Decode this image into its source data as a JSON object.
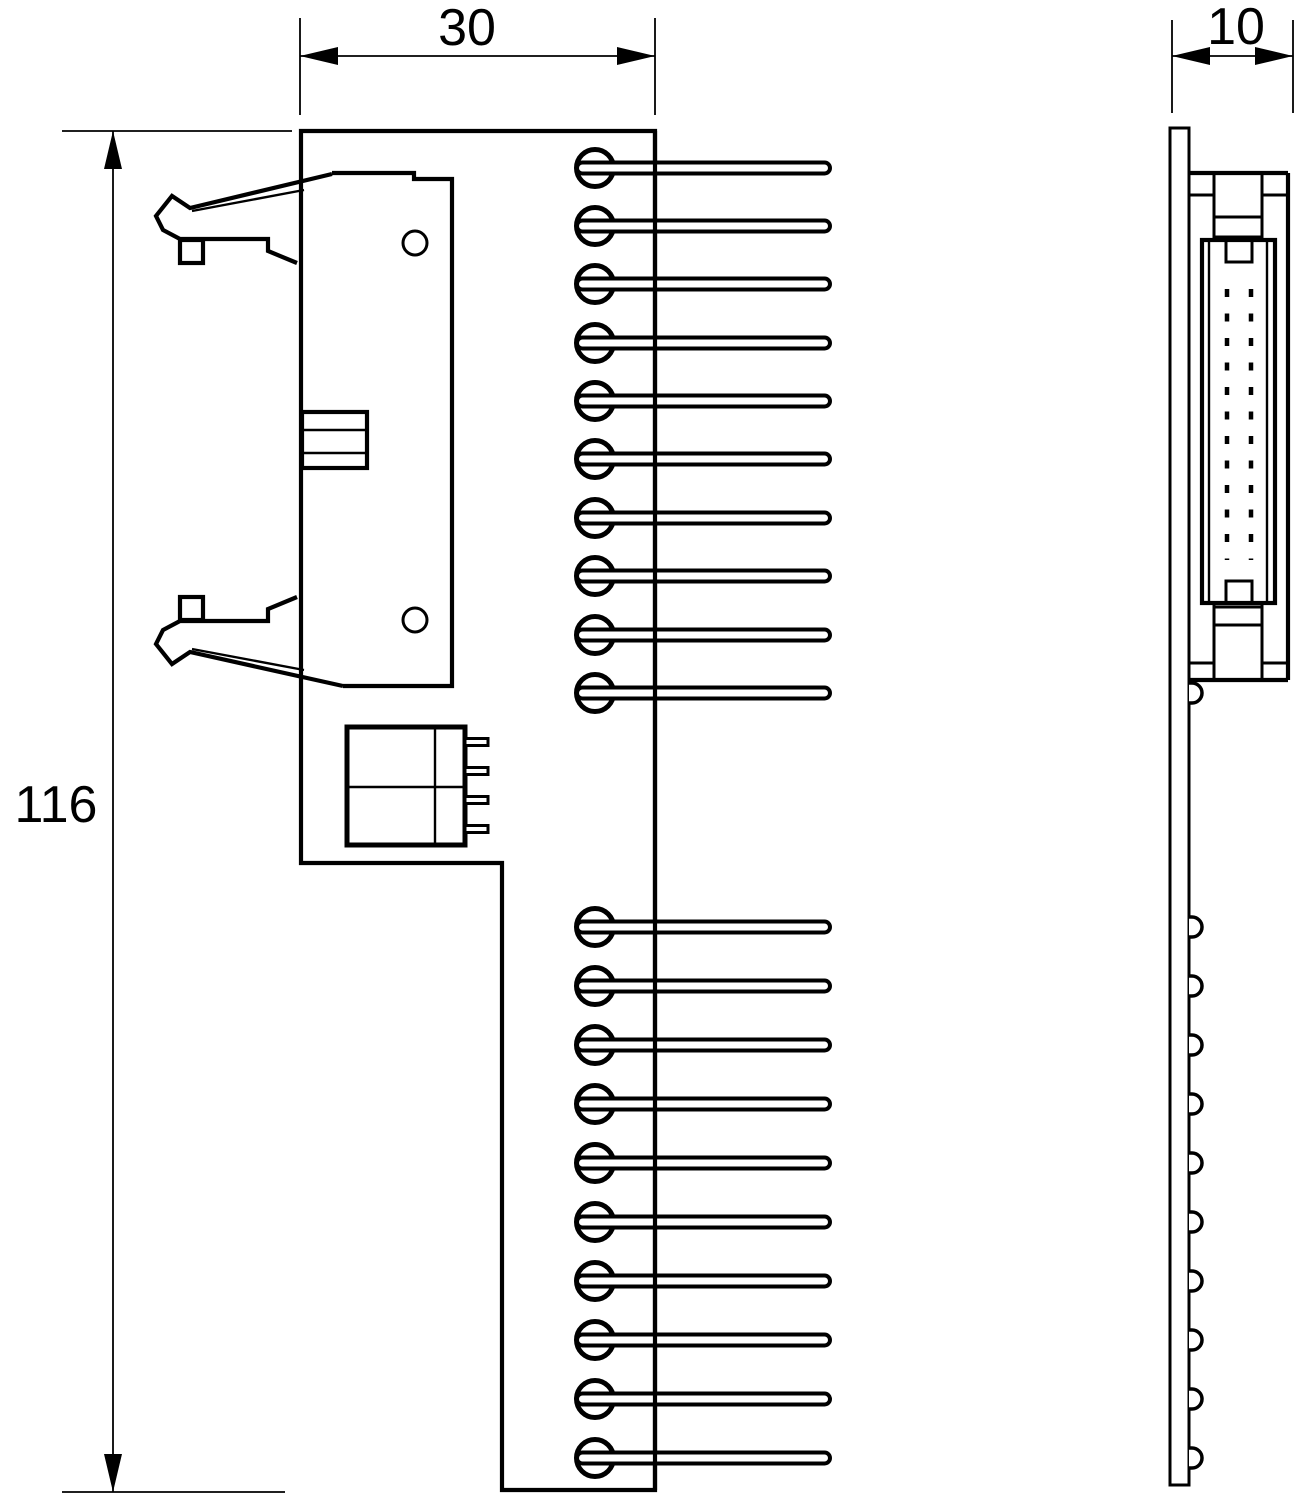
{
  "drawing": {
    "colors": {
      "background": "#ffffff",
      "line": "#000000"
    },
    "dimensions": {
      "front_width": "30",
      "front_height": "116",
      "side_depth": "10"
    },
    "front_view": {
      "upper_pin_ys": [
        168,
        226,
        284,
        343,
        401,
        459,
        518,
        576,
        635,
        693
      ],
      "lower_pin_ys": [
        927,
        986,
        1045,
        1104,
        1163,
        1222,
        1281,
        1340,
        1399,
        1458
      ],
      "relay_pin_ys": [
        742,
        771,
        800,
        829
      ]
    },
    "side_view": {
      "pin_bump_ys": [
        693,
        927,
        986,
        1045,
        1104,
        1163,
        1222,
        1281,
        1340,
        1399,
        1458
      ],
      "dash_column_xs": [
        1227,
        1251
      ],
      "dash_y_start": 289,
      "dash_y_end": 560
    }
  }
}
